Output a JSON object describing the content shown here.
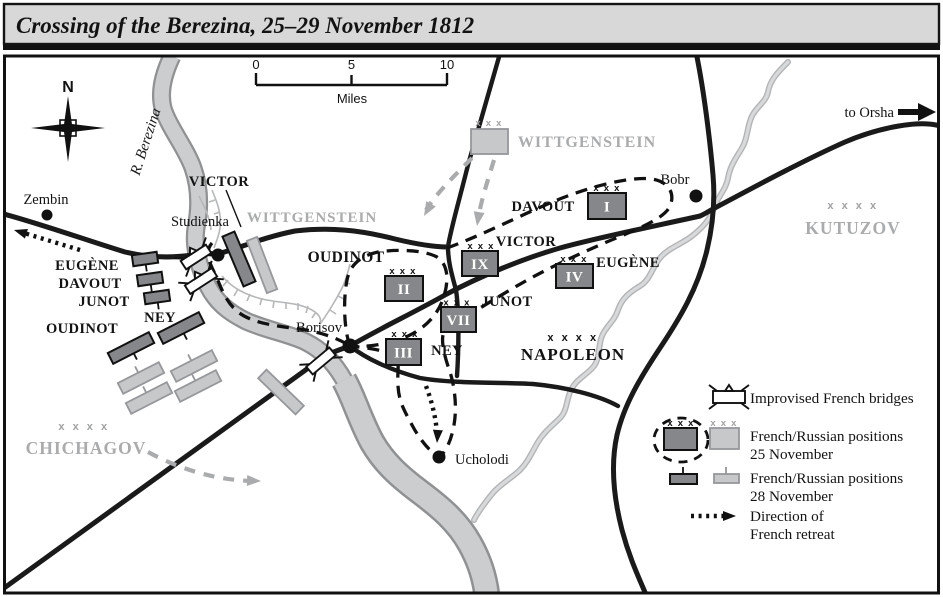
{
  "title": "Crossing of the Berezina, 25–29 November 1812",
  "scale": {
    "t0": "0",
    "t5": "5",
    "t10": "10",
    "unit": "Miles"
  },
  "compass": {
    "n": "N"
  },
  "river": {
    "name": "R. Berezina"
  },
  "route": {
    "to_orsha": "to Orsha"
  },
  "towns": {
    "zembin": "Zembin",
    "studienka": "Studienka",
    "borisov": "Borisov",
    "bobr": "Bobr",
    "ucholodi": "Ucholodi"
  },
  "armies": {
    "wittgenstein": "WITTGENSTEIN",
    "kutuzov": "KUTUZOV",
    "chichagov": "CHICHAGOV",
    "napoleon": "NAPOLEON"
  },
  "ranks": {
    "corps": "x x x",
    "army": "x x x x"
  },
  "corps_east": {
    "davout": "DAVOUT",
    "victor": "VICTOR",
    "oudinot": "OUDINOT",
    "junot": "JUNOT",
    "ney": "NEY",
    "eugene": "EUGÈNE"
  },
  "corps_west": {
    "victor": "VICTOR",
    "eugene": "EUGÈNE",
    "davout": "DAVOUT",
    "junot": "JUNOT",
    "ney": "NEY",
    "oudinot": "OUDINOT"
  },
  "numerals": {
    "i": "I",
    "ix": "IX",
    "ii": "II",
    "iv": "IV",
    "vii": "VII",
    "iii": "III"
  },
  "legend": {
    "bridges": "Improvised French bridges",
    "pos25_line1": "French/Russian positions",
    "pos25_line2": "25 November",
    "pos28_line1": "French/Russian positions",
    "pos28_line2": "28 November",
    "retreat_line1": "Direction of",
    "retreat_line2": "French retreat"
  },
  "colors": {
    "french_unit": "#85878a",
    "russian_unit": "#c6c8ca",
    "russian_text": "#a9abad",
    "river": "#cbcdcf",
    "road": "#1a1a1a",
    "title_bar": "#d8d8d8"
  }
}
